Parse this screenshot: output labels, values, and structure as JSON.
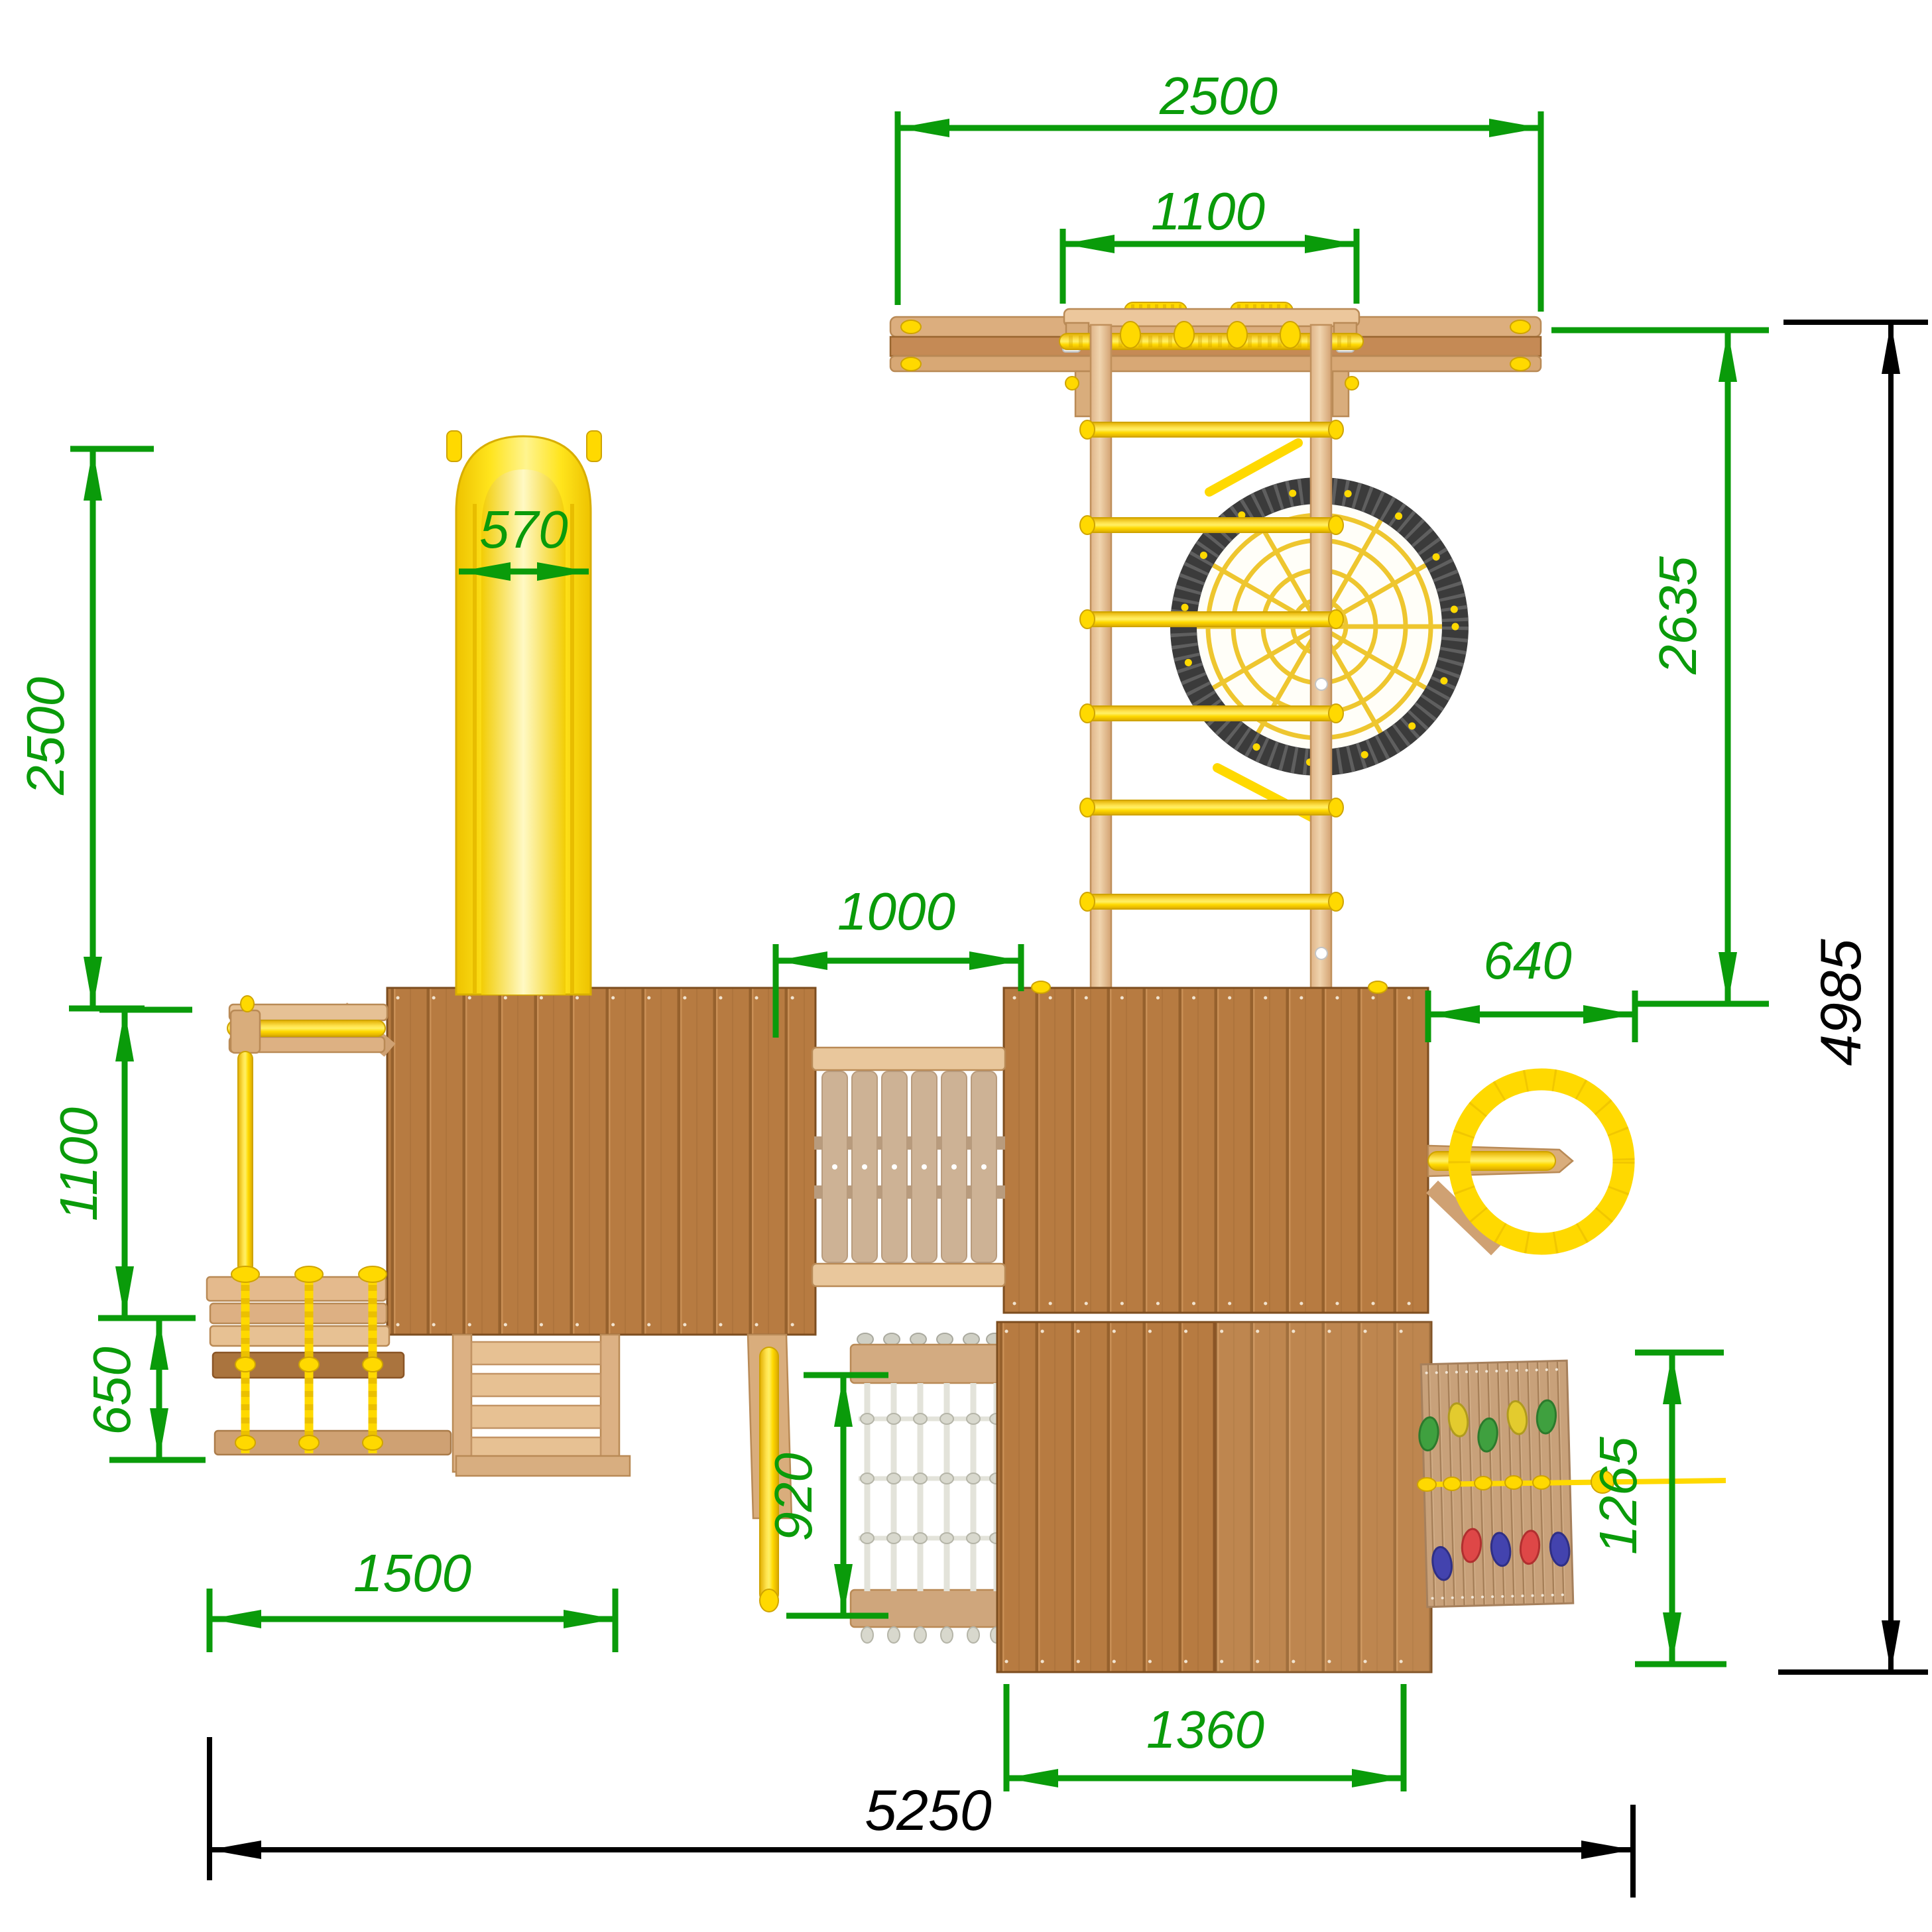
{
  "drawing": {
    "kind": "playground-set-top-view-dimension-drawing",
    "units": "mm",
    "colors": {
      "dimension_green": "#0a9b0a",
      "dimension_black": "#000000",
      "tower_wood": "#b77b41",
      "light_wood": "#e2b487",
      "deck_plank": "#cdb295",
      "accent_yellow": "#ffd900",
      "slide_yellow": "#ffe41c",
      "nest_rim_gray": "#3b3b3b",
      "net_yellow": "#eec62f",
      "rope_white": "#e3e3da",
      "hold_green": "#3fa03f",
      "hold_yellow": "#e3cb2e",
      "hold_red": "#de4747",
      "hold_blue": "#4343ae"
    }
  },
  "dimensions": {
    "top_beam_width": "2500",
    "top_mount_width": "1100",
    "slide_width": "570",
    "slide_length": "2500",
    "swing_frame_depth": "1100",
    "rope_bridge_depth": "650",
    "bridge_span": "1000",
    "wheel_offset": "640",
    "beam_to_tower_depth": "2635",
    "overall_depth": "4985",
    "net_drop": "920",
    "stairs_bay_width": "1500",
    "lower_platform_width": "1360",
    "climbwall_drop": "1265",
    "overall_width": "5250"
  }
}
